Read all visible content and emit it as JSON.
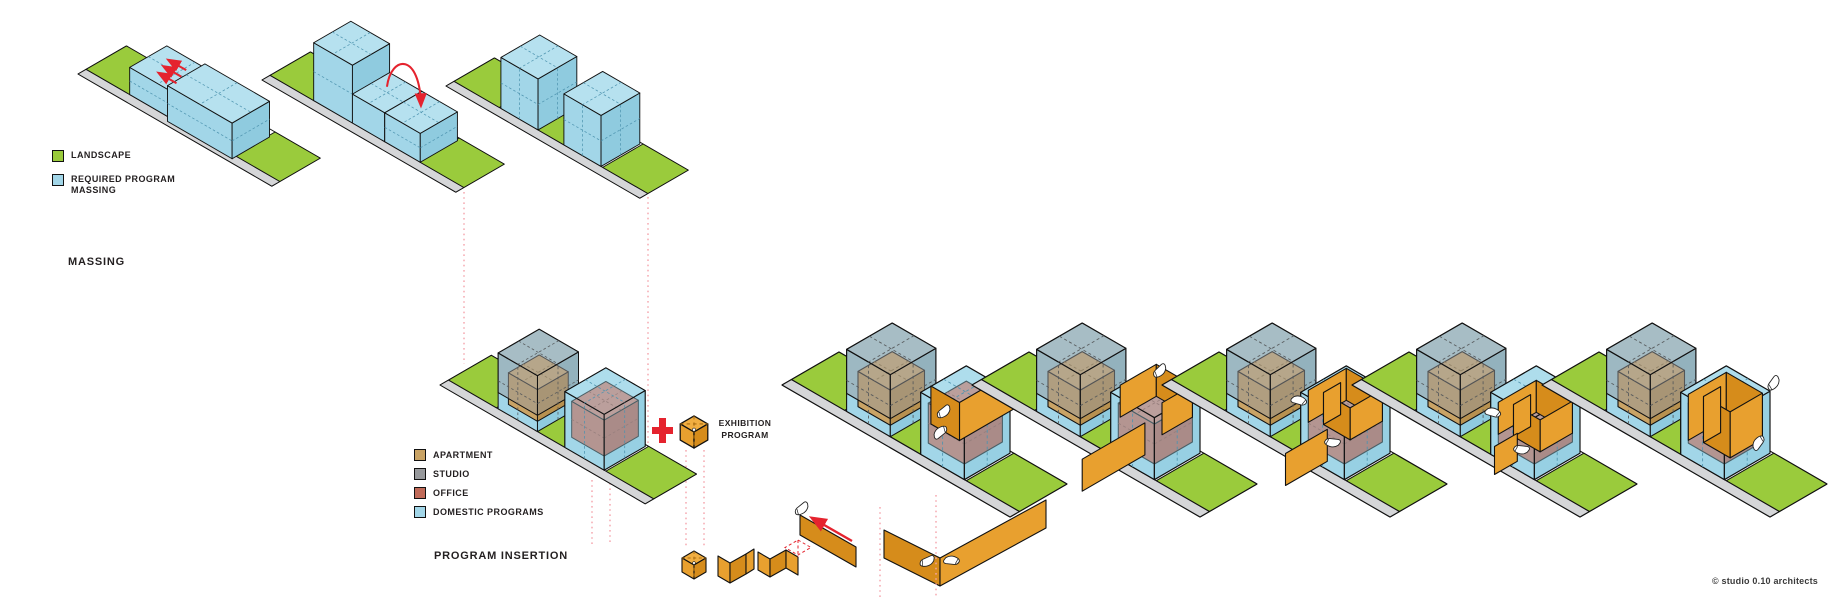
{
  "colors": {
    "landscape": "#9ACB3C",
    "walkway": "#D5D6D8",
    "massing-blue": "#A2D6E8",
    "massing-blue-top": "#B6E1EF",
    "massing-blue-side": "#8FCBDF",
    "apartment": "#C9A365",
    "apartment-top": "#D5B278",
    "apartment-side": "#B8914F",
    "studio": "#97999C",
    "office": "#C06A58",
    "office-top": "#CB7A69",
    "office-side": "#AF5948",
    "ribbon": "#E8A02F",
    "ribbon-top": "#F1AE41",
    "ribbon-side": "#D68C1B",
    "accent-red": "#E5232E",
    "guide-pink": "#F4A3AB",
    "text": "#231F20"
  },
  "sections": {
    "massing_title": "MASSING",
    "program_title": "PROGRAM INSERTION"
  },
  "legend_massing": {
    "items": [
      {
        "label": "LANDSCAPE"
      },
      {
        "label": "REQUIRED PROGRAM MASSING"
      }
    ]
  },
  "legend_program": {
    "items": [
      {
        "label": "APARTMENT"
      },
      {
        "label": "STUDIO"
      },
      {
        "label": "OFFICE"
      },
      {
        "label": "DOMESTIC PROGRAMS"
      }
    ]
  },
  "exhibition": {
    "line1": "EXHIBITION",
    "line2": "PROGRAM"
  },
  "footer": {
    "copyright": "© studio 0.10 architects"
  }
}
